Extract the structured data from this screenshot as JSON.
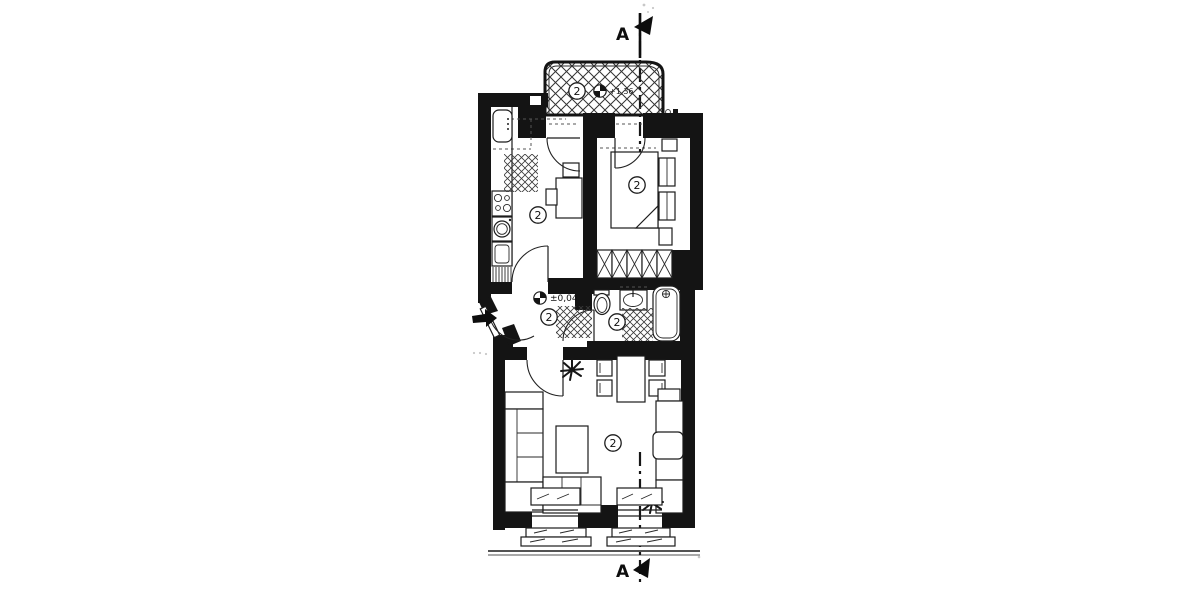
{
  "document": {
    "kind": "Apartment floor plan (scanned blueprint)",
    "colors": {
      "paper": "#ffffff",
      "ink": "#1a1a1a",
      "wall_fill": "#141414"
    }
  },
  "section": {
    "top_label": "A",
    "bottom_label": "A"
  },
  "levels": {
    "hall": "±0,04",
    "balcony": "+1,36"
  },
  "rooms": {
    "balcony": {
      "number": "2"
    },
    "kitchen": {
      "number": "2"
    },
    "bedroom": {
      "number": "2"
    },
    "hall": {
      "number": "2"
    },
    "bathroom": {
      "number": "2"
    },
    "living_room": {
      "number": "2"
    }
  },
  "icons": {
    "level_marker": "quartered-survey-circle",
    "entrance_arrow": "solid-arrow",
    "section_flag": "solid-pennant",
    "plant": "asterisk-burst"
  }
}
